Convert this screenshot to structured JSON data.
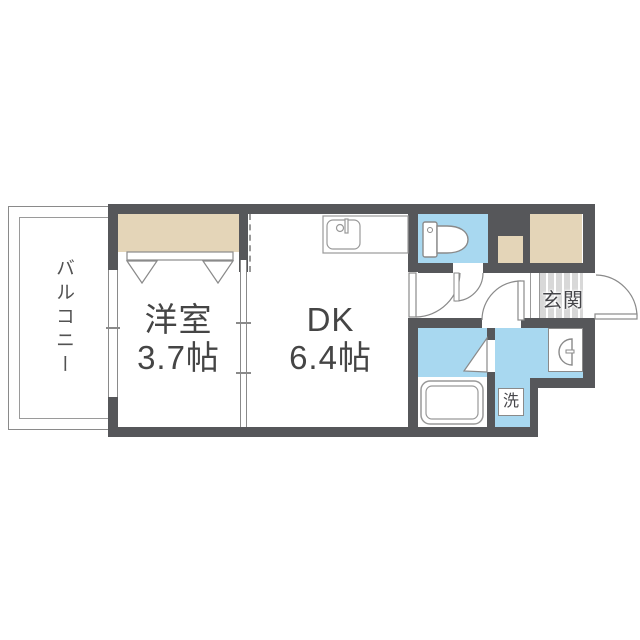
{
  "plan": {
    "type": "apartment-floor-plan",
    "rooms": {
      "balcony": {
        "label": "バルコニー"
      },
      "western": {
        "label": "洋室",
        "area": "3.7帖"
      },
      "dk": {
        "label": "DK",
        "area": "6.4帖"
      },
      "genkan": {
        "label": "玄関"
      },
      "laundry": {
        "label": "洗"
      }
    },
    "fixtures": [
      "kitchen-sink",
      "toilet",
      "bathtub",
      "washbasin",
      "washing-machine-space",
      "closet-double-door",
      "wardrobe",
      "entrance-door",
      "sliding-partition",
      "balcony-window"
    ],
    "colors": {
      "wall": "#56575a",
      "water_area": "#a8d8f0",
      "closet": "#e4d5b8",
      "entrance_tile": "#d8d8d8",
      "thin_line": "#8a8a8a",
      "text": "#454545",
      "background": "#ffffff"
    }
  }
}
